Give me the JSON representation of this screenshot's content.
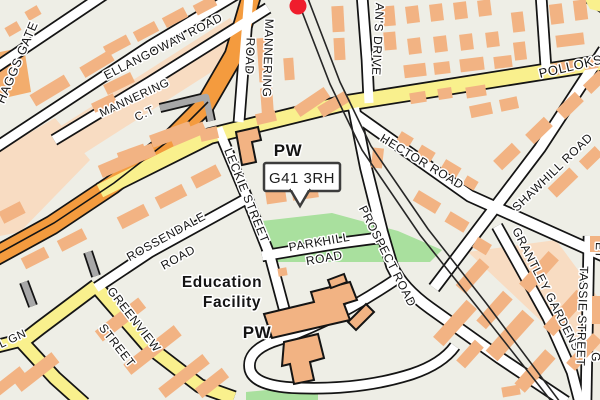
{
  "map": {
    "title": "Street map of G41 3RH area (Pollokshaws, Glasgow)",
    "postcode_callout": {
      "text": "G41 3RH"
    },
    "marker": {
      "shape": "circle",
      "color": "#ef1d2c"
    },
    "colors": {
      "background": "#eeeee6",
      "building": "#f2b383",
      "building_outline": "#141414",
      "road_casing": "#141414",
      "road_white": "#ffffff",
      "road_yellow": "#f9f08d",
      "road_orange": "#f49b3e",
      "road_gray": "#a8a8a8",
      "park_green": "#a9e09e",
      "pale_block": "#f8dcc2",
      "railway": "#262626",
      "marker_red": "#ef1d2c",
      "label": "#141414",
      "halo": "#ffffff",
      "callout_border": "#3d3d3d",
      "callout_bg": "#ffffff"
    },
    "labels": [
      {
        "id": "haggs-gate",
        "text": "HAGGS GATE",
        "x": 21,
        "y": 64,
        "r": -67,
        "s": 12.5
      },
      {
        "id": "ellangowan-road",
        "text": "ELLANGOWAN ROAD",
        "x": 165,
        "y": 50,
        "r": -27,
        "s": 12
      },
      {
        "id": "mannering-road-line1",
        "text": "MANNERING",
        "x": 264,
        "y": 58,
        "r": 92,
        "s": 12
      },
      {
        "id": "mannering-road-line2",
        "text": "ROAD",
        "x": 246,
        "y": 56,
        "r": 92,
        "s": 12
      },
      {
        "id": "mannering-ct-line1",
        "text": "MANNERING",
        "x": 136,
        "y": 101,
        "r": -25,
        "s": 11.5
      },
      {
        "id": "mannering-ct-line2",
        "text": "C.T",
        "x": 146,
        "y": 117,
        "r": -25,
        "s": 11.5
      },
      {
        "id": "ans-drive",
        "text": "AN'S DRIVE",
        "x": 374,
        "y": 39,
        "r": 93,
        "s": 12
      },
      {
        "id": "pollokshaws-road",
        "text": "POLLOKSHAWS ROAD",
        "x": 540,
        "y": 78,
        "r": -13,
        "s": 13,
        "anchor": "start"
      },
      {
        "id": "pw-north",
        "text": "PW",
        "x": 288,
        "y": 156,
        "s": 17,
        "w": 700
      },
      {
        "id": "hector-road",
        "text": "HECTOR ROAD",
        "x": 420,
        "y": 165,
        "r": 31,
        "s": 12
      },
      {
        "id": "leckie-street",
        "text": "LECKIE STREET",
        "x": 243,
        "y": 197,
        "r": 68,
        "s": 12
      },
      {
        "id": "prospect-road",
        "text": "PROSPECT ROAD",
        "x": 384,
        "y": 258,
        "r": 63,
        "s": 12
      },
      {
        "id": "rossendale-road-line1",
        "text": "ROSSENDALE",
        "x": 168,
        "y": 240,
        "r": -29,
        "s": 12
      },
      {
        "id": "rossendale-road-line2",
        "text": "ROAD",
        "x": 180,
        "y": 261,
        "r": -29,
        "s": 12
      },
      {
        "id": "parkhill-road-line1",
        "text": "PARKHILL",
        "x": 320,
        "y": 246,
        "r": -10,
        "s": 12
      },
      {
        "id": "parkhill-road-line2",
        "text": "ROAD",
        "x": 325,
        "y": 262,
        "r": -10,
        "s": 12
      },
      {
        "id": "education-facility-line1",
        "text": "Education",
        "x": 222,
        "y": 287,
        "s": 15.5,
        "w": 700
      },
      {
        "id": "education-facility-line2",
        "text": "Facility",
        "x": 232,
        "y": 307,
        "s": 15.5,
        "w": 700
      },
      {
        "id": "pw-south",
        "text": "PW",
        "x": 257,
        "y": 338,
        "s": 17,
        "w": 700
      },
      {
        "id": "greenview-street-line1",
        "text": "GREENVIEW",
        "x": 131,
        "y": 322,
        "r": 52,
        "s": 12
      },
      {
        "id": "greenview-street-line2",
        "text": "STREET",
        "x": 114,
        "y": 348,
        "r": 52,
        "s": 12
      },
      {
        "id": "gn-fragment",
        "text": "L GN",
        "x": 14,
        "y": 342,
        "r": -25,
        "s": 11.5
      },
      {
        "id": "shawhill-road",
        "text": "SHAWHILL ROAD",
        "x": 517,
        "y": 212,
        "r": -44,
        "s": 12,
        "anchor": "start"
      },
      {
        "id": "grantley-gardens",
        "text": "GRANTLEY GARDENS",
        "x": 543,
        "y": 291,
        "r": 63,
        "s": 12
      },
      {
        "id": "tassie-street",
        "text": "TASSIE STREET",
        "x": 580,
        "y": 266,
        "r": 92,
        "s": 12,
        "anchor": "start"
      },
      {
        "id": "et-fragment",
        "text": "ET",
        "x": 596,
        "y": 242,
        "r": 92,
        "s": 12,
        "anchor": "start"
      },
      {
        "id": "g-fragment",
        "text": "G",
        "x": 592,
        "y": 352,
        "r": 92,
        "s": 12,
        "anchor": "start"
      }
    ]
  }
}
